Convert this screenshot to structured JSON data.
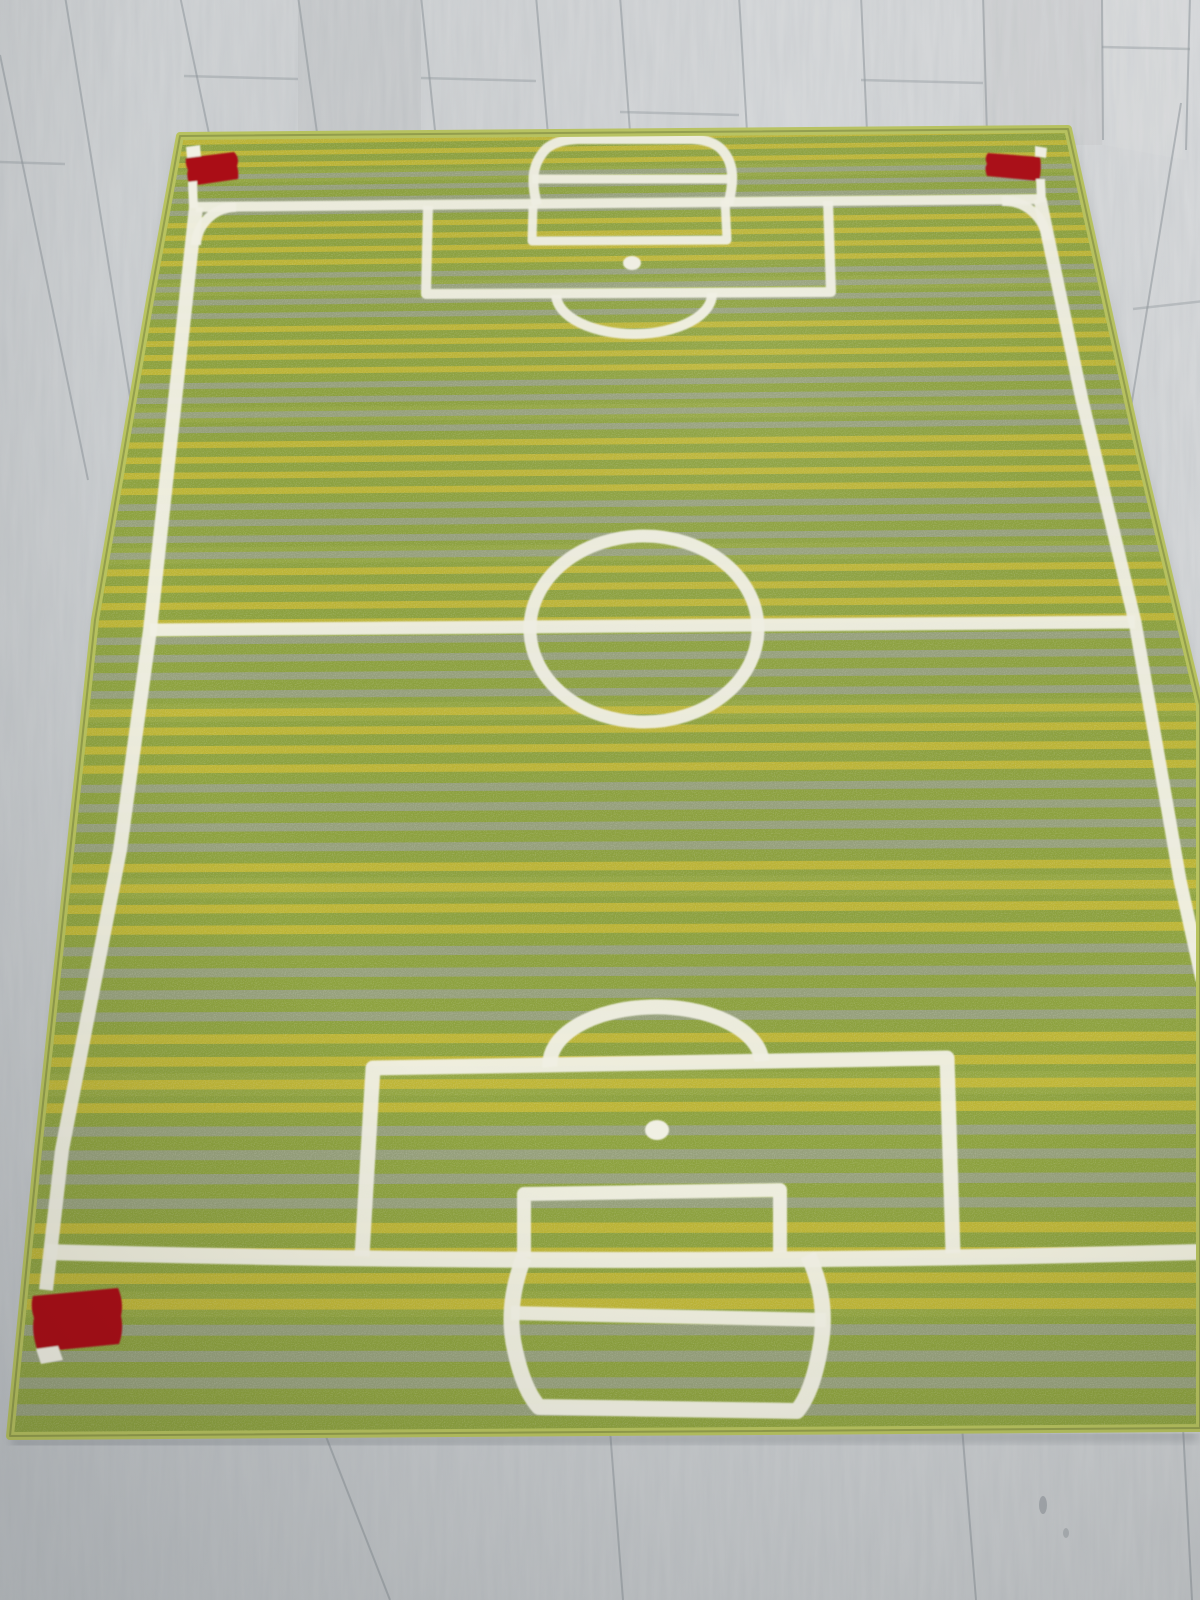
{
  "meta": {
    "description": "Photograph of a rectangular kids football pitch rug on pale grey laminate wood flooring, viewed in perspective from one end",
    "visible_text": ""
  },
  "colors": {
    "floor_base": "#cdd0d2",
    "floor_light": "#d9dbdd",
    "floor_dark": "#c0c4c7",
    "floor_seam": "#8e959a",
    "grass": "#8da23e",
    "grass_light": "#a7b34b",
    "stripe_yellow": "#cabb33",
    "stripe_gray": "#9aa08f",
    "line": "#f1f0e4",
    "red": "#ab1019",
    "binding": "#b8c35f",
    "binding_dark": "#747f3c",
    "shadow": "#70767b"
  },
  "stripes": {
    "top": 128,
    "slots": 72,
    "h0": 11.2,
    "ratio": 1.0125,
    "tilt": 16,
    "stripe_frac": 0.42,
    "light_every": 9,
    "cycle": [
      "yellow",
      "yellow",
      "yellow",
      "yellow",
      "gray",
      "gray",
      "gray",
      "gray"
    ]
  },
  "rug": {
    "kind": "football-pitch-kids-rug",
    "markings": [
      "outer touchlines",
      "halfway line",
      "centre circle",
      "penalty area top",
      "goal area top",
      "penalty spot top",
      "penalty arc top",
      "goal top",
      "penalty area bottom",
      "goal area bottom",
      "penalty spot bottom",
      "penalty arc bottom",
      "goal bottom",
      "corner arcs",
      "red corner flags"
    ],
    "flag_count_visible": 3
  },
  "floor": {
    "kind": "laminate-wood-planks",
    "plank_joint_style": "staggered butt joints"
  }
}
